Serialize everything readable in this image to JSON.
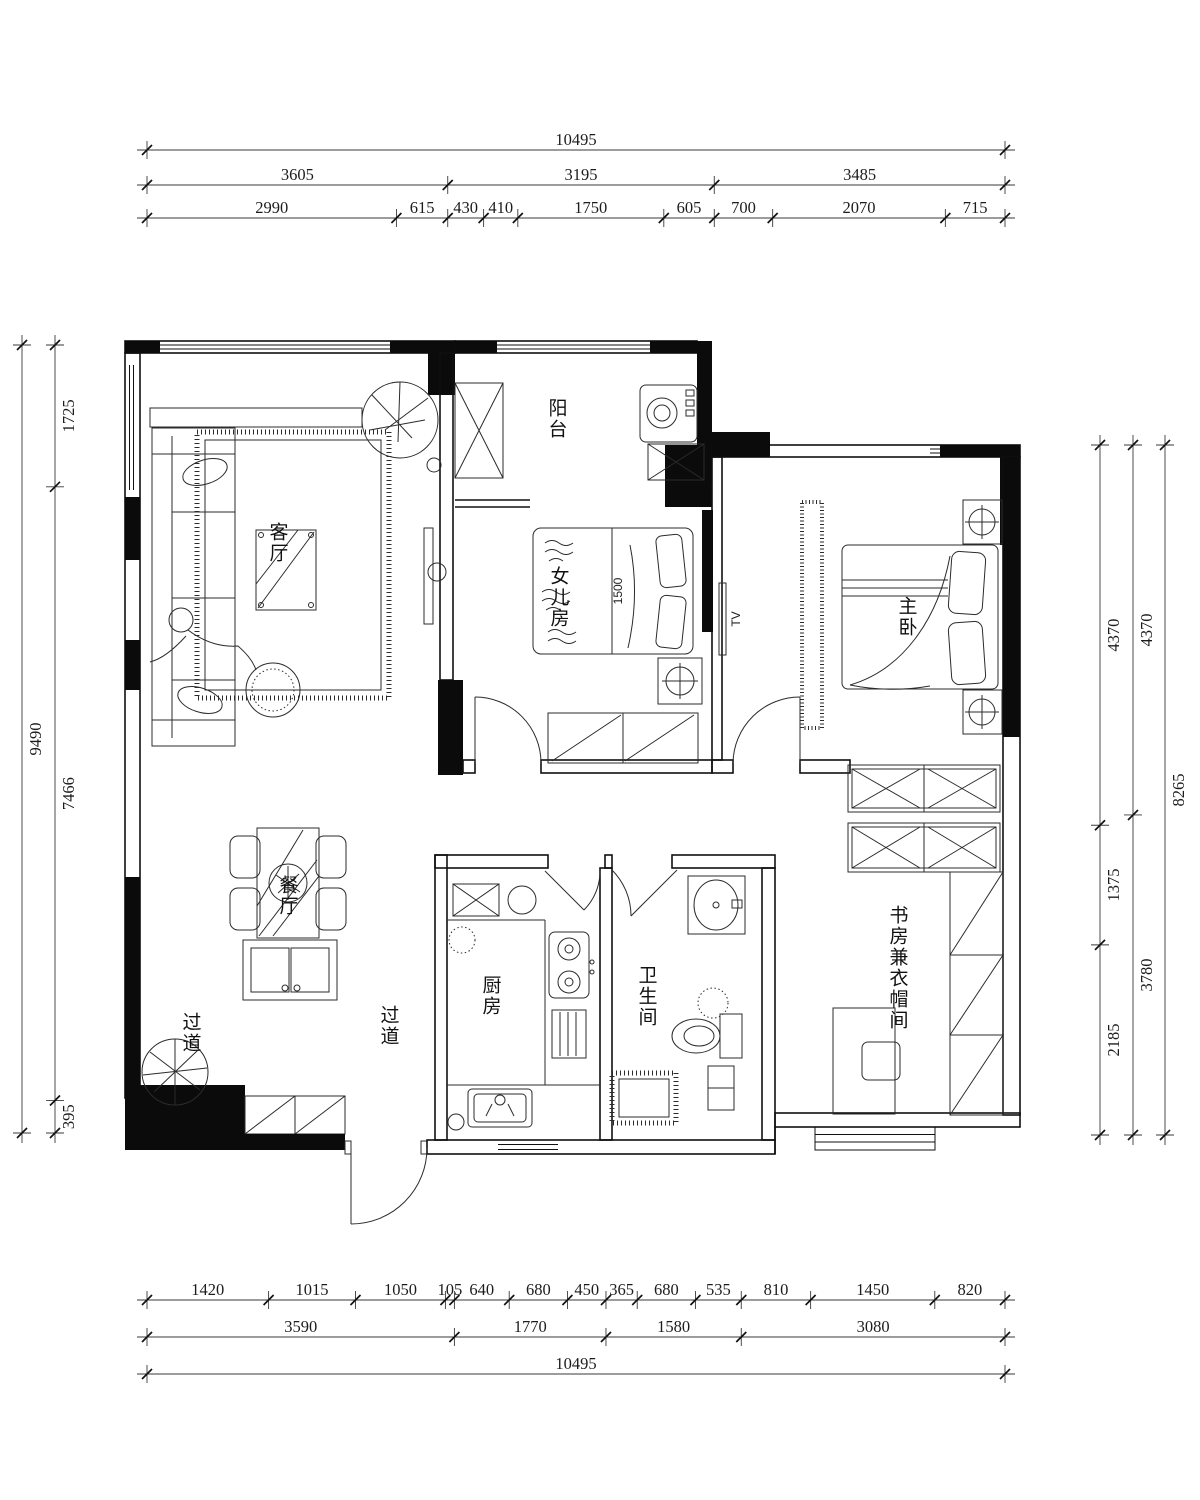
{
  "rooms": {
    "living": "客厅",
    "balcony": "阳台",
    "daughter": "女儿房",
    "master": "主卧",
    "dining": "餐厅",
    "corridor1": "过道",
    "corridor2": "过道",
    "kitchen": "厨房",
    "bathroom": "卫生间",
    "study": "书房兼衣帽间"
  },
  "annotations": {
    "bed_width": "1500",
    "tv": "TV"
  },
  "dimensions": {
    "top": {
      "row_total": [
        "10495"
      ],
      "row_mid": [
        "3605",
        "3195",
        "3485"
      ],
      "row_detail": [
        "2990",
        "615",
        "430",
        "410",
        "1750",
        "605",
        "700",
        "2070",
        "715"
      ]
    },
    "bottom": {
      "row_detail": [
        "1420",
        "1015",
        "1050",
        "105",
        "640",
        "680",
        "450",
        "365",
        "680",
        "535",
        "810",
        "1450",
        "820"
      ],
      "row_mid": [
        "3590",
        "1770",
        "1580",
        "3080"
      ],
      "row_total": [
        "10495"
      ]
    },
    "left": {
      "outer": [
        "9490"
      ],
      "inner": [
        "1725",
        "7466",
        "395"
      ]
    },
    "right": {
      "inner": [
        "4370",
        "1375",
        "2185"
      ],
      "mid": [
        "4370",
        "3780"
      ],
      "outer": [
        "8265"
      ]
    }
  },
  "colors": {
    "line": "#101010",
    "background": "#ffffff"
  }
}
